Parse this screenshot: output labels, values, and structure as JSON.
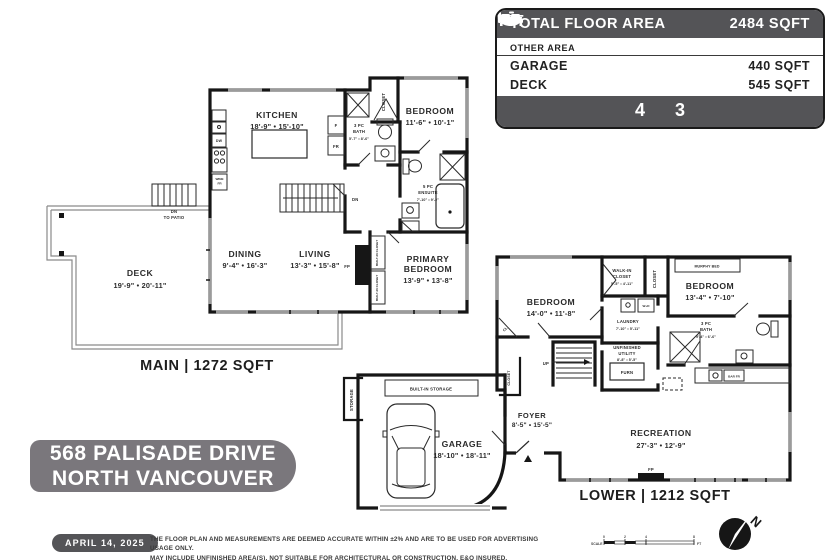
{
  "summary": {
    "title": "TOTAL FLOOR AREA",
    "total": "2484 SQFT",
    "other_area": "OTHER AREA",
    "rows": [
      {
        "label": "GARAGE",
        "value": "440 SQFT"
      },
      {
        "label": "DECK",
        "value": "545 SQFT"
      }
    ],
    "beds": "4",
    "baths": "3",
    "colors": {
      "header_bg": "#545457",
      "badge_bg": "#7a777c"
    }
  },
  "address": {
    "line1": "568 PALISADE DRIVE",
    "line2": "NORTH VANCOUVER"
  },
  "footer": {
    "date": "APRIL 14, 2025",
    "disclaimer1": "THE FLOOR PLAN AND MEASUREMENTS ARE DEEMED ACCURATE WITHIN ±2% AND ARE TO BE USED FOR ADVERTISING USAGE ONLY.",
    "disclaimer2": "MAY INCLUDE UNFINISHED AREA(S). NOT SUITABLE FOR ARCHITECTURAL OR CONSTRUCTION. E&O INSURED.",
    "scale_label": "SCALE",
    "scale_t0": "0",
    "scale_t1": "2",
    "scale_t2": "4",
    "scale_t3": "8",
    "scale_unit": "FT",
    "north": "N"
  },
  "main": {
    "title": "MAIN | 1272 SQFT",
    "kitchen_name": "KITCHEN",
    "kitchen_dims": "18'-9\" • 15'-10\"",
    "bedroom_name": "BEDROOM",
    "bedroom_dims": "11'-6\" • 10'-1\"",
    "dining_name": "DINING",
    "dining_dims": "9'-4\" • 16'-3\"",
    "living_name": "LIVING",
    "living_dims": "13'-3\" • 15'-8\"",
    "primary_name1": "PRIMARY",
    "primary_name2": "BEDROOM",
    "primary_dims": "13'-9\" • 13'-8\"",
    "deck_name": "DECK",
    "deck_dims": "19'-9\" • 20'-11\"",
    "bath_name1": "3 PC",
    "bath_name2": "BATH",
    "bath_dims": "5'-7\" • 8'-6\"",
    "ensuite_name1": "5 PC",
    "ensuite_name2": "ENSUITE",
    "ensuite_dims": "7'-10\" • 9'-2\"",
    "dn": "DN",
    "dn_patio1": "DN",
    "dn_patio2": "TO PATIO",
    "fp": "FP",
    "closet": "CLOSET",
    "builtin_closet": "BUILT-IN CLOSET",
    "dw": "DW",
    "wine1": "WINE",
    "wine2": "FR",
    "f": "F",
    "fr": "FR"
  },
  "lower": {
    "title": "LOWER | 1212 SQFT",
    "bedroom_l_name": "BEDROOM",
    "bedroom_l_dims": "14'-0\" • 11'-8\"",
    "bedroom_r_name": "BEDROOM",
    "bedroom_r_dims": "13'-4\" • 7'-10\"",
    "walkin_name1": "WALK-IN",
    "walkin_name2": "CLOSET",
    "walkin_dims": "5'-5\" • 4'-11\"",
    "laundry_name": "LAUNDRY",
    "laundry_dims": "7'-10\" • 5'-11\"",
    "bath_name1": "3 PC",
    "bath_name2": "BATH",
    "bath_dims": "9'-4\" • 6'-6\"",
    "utility_name1": "UNFINISHED",
    "utility_name2": "UTILITY",
    "utility_dims": "8'-8\" • 5'-5\"",
    "recreation_name": "RECREATION",
    "recreation_dims": "27'-3\" • 12'-9\"",
    "garage_name": "GARAGE",
    "garage_dims": "18'-10\" • 18'-11\"",
    "foyer_name": "FOYER",
    "foyer_dims": "8'-5\" • 15'-5\"",
    "murphy": "MURPHY BED",
    "closet": "CLOSET",
    "cl": "CL",
    "wd": "W+D",
    "furn": "FURN",
    "up": "UP",
    "storage": "STORAGE",
    "builtin_storage": "BUILT-IN STORAGE",
    "bar": "BAR FR",
    "fp": "FP"
  }
}
